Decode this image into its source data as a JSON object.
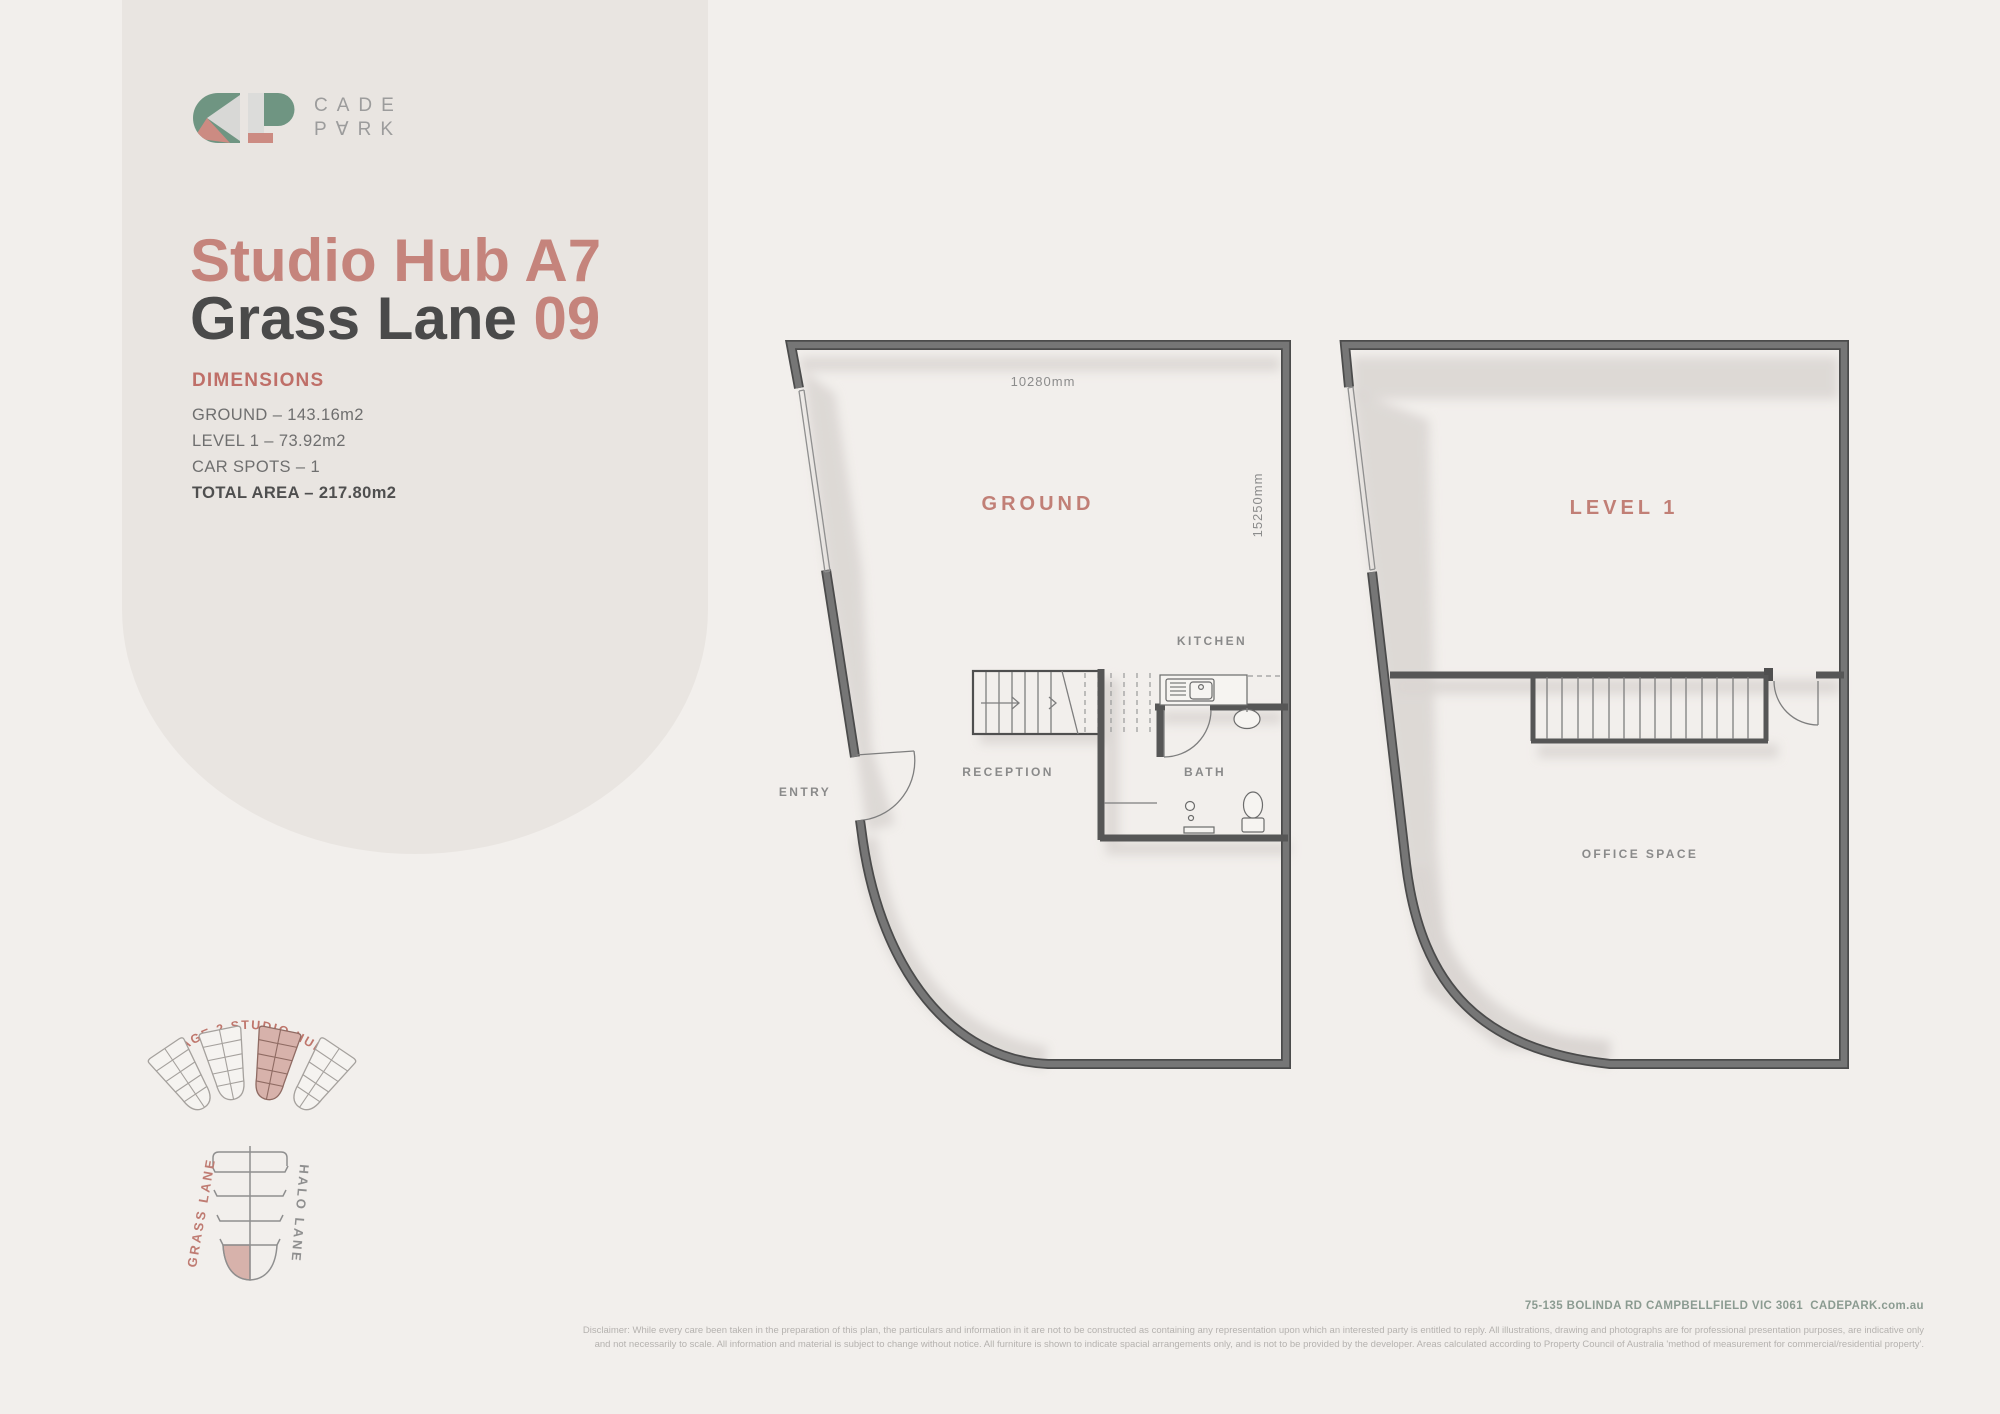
{
  "brand": {
    "line1": "CADE",
    "line2": "P∀RK"
  },
  "title": {
    "line1": "Studio Hub A7",
    "line2_name": "Grass Lane",
    "line2_number": "09"
  },
  "dimensions": {
    "heading": "DIMENSIONS",
    "ground": "GROUND – 143.16m2",
    "level1": "LEVEL 1 – 73.92m2",
    "car_spots": "CAR SPOTS – 1",
    "total": "TOTAL AREA – 217.80m2"
  },
  "ground_plan": {
    "label": "GROUND",
    "width_dimension": "10280mm",
    "depth_dimension": "15250mm",
    "entry": "ENTRY",
    "reception": "RECEPTION",
    "kitchen": "KITCHEN",
    "bath": "BATH"
  },
  "level1_plan": {
    "label": "LEVEL 1",
    "office": "OFFICE SPACE"
  },
  "site_diagram": {
    "stage_label": "STAGE 2 STUDIO HUBS",
    "left_lane": "GRASS LANE",
    "right_lane": "HALO LANE"
  },
  "footer": {
    "address": "75-135 BOLINDA RD CAMPBELLFIELD VIC 3061  CADEPARK.com.au",
    "disclaimer_line1": "Disclaimer: While every care been taken in the preparation of this plan, the particulars and information in it are not to be constructed as containing any representation upon which an interested party is entitled to reply. All illustrations, drawing and photographs are for professional presentation purposes, are indicative only",
    "disclaimer_line2": "and not necessarily to scale. All information and material is subject to change without notice. All furniture is shown to indicate spacial arrangements only, and is not to be provided by the developer. Areas calculated according to Property Council of Australia 'method of measurement for commercial/residential property'."
  },
  "colors": {
    "background": "#f2efec",
    "panel": "#e9e5e1",
    "accent_salmon": "#c5847c",
    "brand_green": "#6f9582",
    "brand_pink": "#cc8b82",
    "wall_gray": "#6e6e6e",
    "text_dark": "#4a4a4a",
    "text_gray": "#8a8a8a",
    "address_sage": "#8b9b91",
    "highlight_pink": "#d7b2ab"
  }
}
